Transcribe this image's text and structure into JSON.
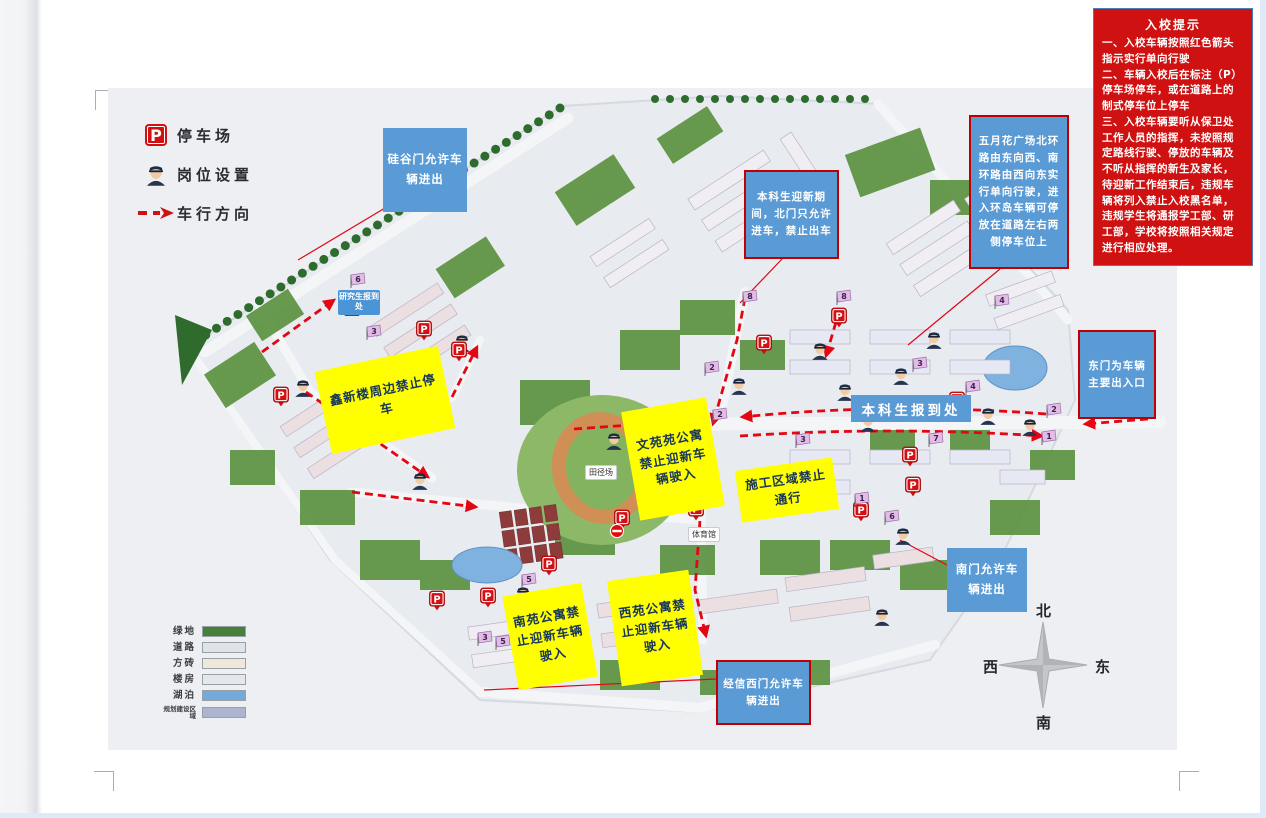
{
  "notice": {
    "title": "入校提示",
    "bg_color": "#cf1111",
    "items": [
      "一、入校车辆按照红色箭头指示实行单向行驶",
      "二、车辆入校后在标注（P）停车场停车，或在道路上的制式停车位上停车",
      "三、入校车辆要听从保卫处工作人员的指挥，未按照规定路线行驶、停放的车辆及不听从指挥的新生及家长，待迎新工作结束后，违规车辆将列入禁止入校黑名单，违规学生将通报学工部、研工部，学校将按照相关规定进行相应处理。"
    ]
  },
  "legend": {
    "items": [
      {
        "icon": "parking-icon",
        "label": "停车场"
      },
      {
        "icon": "officer-icon",
        "label": "岗位设置"
      },
      {
        "icon": "dashed-arrow-icon",
        "label": "车行方向"
      }
    ]
  },
  "map_legend": {
    "items": [
      {
        "label": "绿地",
        "color": "#46803a"
      },
      {
        "label": "道路",
        "color": "#dfe3ea"
      },
      {
        "label": "方砖",
        "color": "#eee8da"
      },
      {
        "label": "楼房",
        "color": "#e4e7eb"
      },
      {
        "label": "湖泊",
        "color": "#74aad9"
      },
      {
        "label": "规划建设区域",
        "color": "#adb4cf"
      }
    ]
  },
  "compass": {
    "north": "北",
    "south": "南",
    "west": "西",
    "east": "东"
  },
  "accent_colors": {
    "arrow_red": "#e30613",
    "callout_blue": "#5b9bd5",
    "callout_yellow": "#ffff00",
    "callout_border_red": "#c00000"
  },
  "callouts": [
    {
      "name": "callout-guigu-gate",
      "style": "blue",
      "text": "硅谷门允许车辆进出",
      "x": 383,
      "y": 128,
      "w": 84,
      "h": 84
    },
    {
      "name": "callout-north-gate",
      "style": "blue-red",
      "text": "本科生迎新期间，北门只允许进车，禁止出车",
      "x": 744,
      "y": 170,
      "w": 95,
      "h": 89
    },
    {
      "name": "callout-mayflower-plaza",
      "style": "blue-red",
      "text": "五月花广场北环路由东向西、南环路由西向东实行单向行驶，进入环岛车辆可停放在道路左右两侧停车位上",
      "x": 969,
      "y": 115,
      "w": 100,
      "h": 154
    },
    {
      "name": "callout-east-gate",
      "style": "blue-red",
      "text": "东门为车辆主要出入口",
      "x": 1078,
      "y": 330,
      "w": 78,
      "h": 89
    },
    {
      "name": "callout-south-gate",
      "style": "blue",
      "text": "南门允许车辆进出",
      "x": 947,
      "y": 548,
      "w": 80,
      "h": 64
    },
    {
      "name": "callout-jingxin-west-gate",
      "style": "blue-red",
      "text": "经信西门允许车辆进出",
      "x": 716,
      "y": 660,
      "w": 95,
      "h": 65
    },
    {
      "name": "callout-xinxin-building",
      "style": "yellow",
      "text": "鑫新楼周边禁止停车",
      "x": 322,
      "y": 358,
      "w": 126,
      "h": 84,
      "rot": -12
    },
    {
      "name": "callout-wenyuan-dorm",
      "style": "yellow",
      "text": "文苑苑公寓禁止迎新车辆驶入",
      "x": 630,
      "y": 404,
      "w": 86,
      "h": 110,
      "rot": -10
    },
    {
      "name": "callout-construction-zone",
      "style": "yellow",
      "text": "施工区域禁止通行",
      "x": 738,
      "y": 464,
      "w": 98,
      "h": 52,
      "rot": -8
    },
    {
      "name": "callout-nanyuan-dorm",
      "style": "yellow",
      "text": "南苑公寓禁止迎新车辆驶入",
      "x": 510,
      "y": 589,
      "w": 80,
      "h": 95,
      "rot": -10
    },
    {
      "name": "callout-xiyuan-dorm",
      "style": "yellow",
      "text": "西苑公寓禁止迎新车辆驶入",
      "x": 614,
      "y": 575,
      "w": 82,
      "h": 106,
      "rot": -8
    },
    {
      "name": "callout-undergrad-registration",
      "style": "blue-band",
      "text": "本科生报到处",
      "x": 851,
      "y": 395,
      "w": 120,
      "h": 27
    }
  ],
  "map_labels": [
    {
      "name": "label-grad-registration",
      "style": "blue-label",
      "text": "研究生报到处",
      "x": 338,
      "y": 290,
      "w": 42
    },
    {
      "name": "label-track-field",
      "style": "white-label",
      "text": "田径场",
      "x": 585,
      "y": 465
    },
    {
      "name": "label-gymnasium",
      "style": "white-label",
      "text": "体育馆",
      "x": 688,
      "y": 527
    }
  ],
  "markers": {
    "parking": [
      [
        281,
        396
      ],
      [
        424,
        330
      ],
      [
        459,
        351
      ],
      [
        764,
        344
      ],
      [
        839,
        317
      ],
      [
        910,
        456
      ],
      [
        861,
        511
      ],
      [
        957,
        401
      ],
      [
        696,
        510
      ],
      [
        549,
        565
      ],
      [
        437,
        600
      ],
      [
        488,
        597
      ],
      [
        622,
        519
      ],
      [
        913,
        486
      ]
    ],
    "officers": [
      [
        352,
        306
      ],
      [
        462,
        342
      ],
      [
        303,
        387
      ],
      [
        420,
        480
      ],
      [
        523,
        594
      ],
      [
        649,
        610
      ],
      [
        684,
        474
      ],
      [
        739,
        385
      ],
      [
        820,
        350
      ],
      [
        845,
        391
      ],
      [
        868,
        422
      ],
      [
        901,
        375
      ],
      [
        934,
        339
      ],
      [
        988,
        415
      ],
      [
        903,
        535
      ],
      [
        882,
        616
      ],
      [
        614,
        440
      ],
      [
        664,
        443
      ],
      [
        1030,
        426
      ]
    ],
    "flags": [
      [
        6,
        351,
        288
      ],
      [
        3,
        367,
        340
      ],
      [
        8,
        743,
        305
      ],
      [
        2,
        705,
        376
      ],
      [
        2,
        713,
        423
      ],
      [
        8,
        837,
        305
      ],
      [
        3,
        913,
        372
      ],
      [
        4,
        966,
        395
      ],
      [
        4,
        995,
        309
      ],
      [
        2,
        1047,
        418
      ],
      [
        1,
        1042,
        445
      ],
      [
        3,
        796,
        448
      ],
      [
        5,
        522,
        588
      ],
      [
        5,
        496,
        650
      ],
      [
        3,
        478,
        646
      ],
      [
        1,
        855,
        507
      ],
      [
        6,
        885,
        525
      ],
      [
        7,
        929,
        447
      ]
    ],
    "no_entry": [
      [
        682,
        494
      ],
      [
        617,
        531
      ]
    ]
  },
  "arrows": [
    "M745,298 L737,340 L722,392 L713,424",
    "M1046,414 Q890,402 742,417",
    "M740,436 Q890,426 1042,436",
    "M712,444 L700,520 L695,590 L706,636",
    "M262,352 L334,300",
    "M306,392 L428,477",
    "M352,492 L476,507",
    "M452,397 L477,347",
    "M574,429 L688,421",
    "M1148,419 L1085,424",
    "M836,322 L826,356"
  ],
  "leader_lines": [
    [
      390,
      205,
      298,
      260
    ],
    [
      782,
      259,
      740,
      303
    ],
    [
      1000,
      269,
      908,
      345
    ],
    [
      947,
      565,
      900,
      540
    ],
    [
      716,
      679,
      484,
      690
    ]
  ]
}
